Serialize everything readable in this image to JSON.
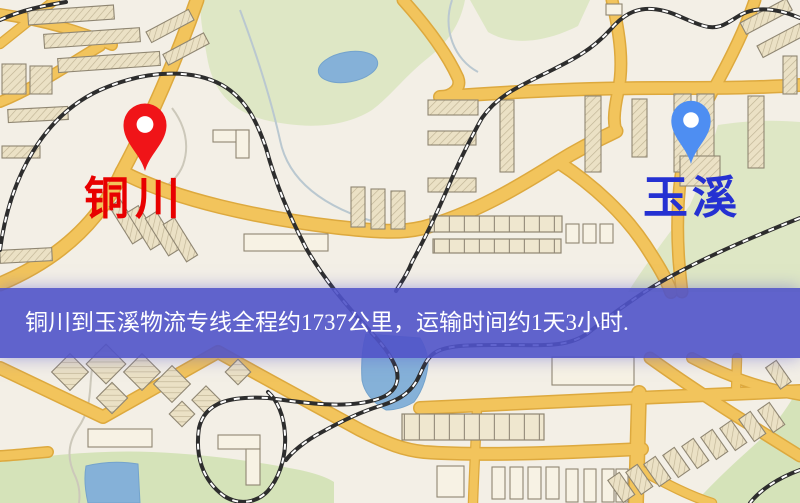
{
  "map": {
    "banner": {
      "text": "铜川到玉溪物流专线全程约1737公里，运输时间约1天3小时."
    },
    "origin": {
      "label": "铜川"
    },
    "destination": {
      "label": "玉溪"
    },
    "colors": {
      "bg": "#f3efe6",
      "road": "#f2c45c",
      "road-casing": "#dda93e",
      "building": "#ece2c6",
      "building-stroke": "#8f8672",
      "park": "#d5e3b9",
      "water": "#85b1d8",
      "railway": "#2d2d2d",
      "banner-bg": "rgba(80,83,201,0.9)",
      "banner-text": "#ffffff",
      "origin-label": "#e80000",
      "origin-pin": "#f01418",
      "destination-label": "#2531d2",
      "destination-pin": "#4e8ef2"
    }
  }
}
